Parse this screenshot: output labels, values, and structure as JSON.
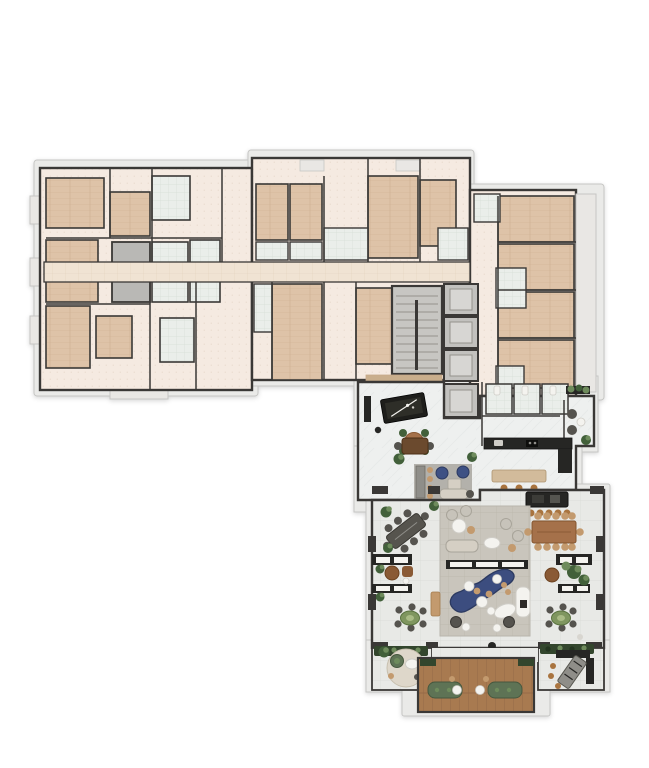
{
  "meta": {
    "label": "residential floor plan with apartment wings, circulation core and amenity pool terrace",
    "page_background": "#ffffff"
  },
  "areas": [
    "west-apartments-wing",
    "north-apartments-wing",
    "east-apartments-wing",
    "central-corridor",
    "stair-core",
    "elevator-bank",
    "games-lounge",
    "pool-table",
    "lounge-seating",
    "restrooms",
    "reading-nook",
    "kitchen",
    "island-counter",
    "outdoor-bar",
    "pool-terrace",
    "plunge-pool",
    "dining-terrace-west",
    "dining-terrace-east",
    "planter-benches",
    "bistro-tables",
    "sun-deck",
    "outdoor-sofas",
    "grill-station",
    "round-lounge-rug",
    "hedges"
  ],
  "palette": {
    "wall": "#3a3836",
    "slab": "#eaeae8",
    "slabStroke": "#c6c6c4",
    "balcony": "#e9e7e4",
    "unitFloor": "#f5eae1",
    "unitDot": "#e3d3c5",
    "woodFloor": "#dec3a8",
    "woodLine": "#c8a98a",
    "tileFloor": "#eaeeea",
    "tileLine": "#d6ded6",
    "corridorFloor": "#f0e3d3",
    "corridorLine": "#e1d1bd",
    "shaft": "#b9b8b5",
    "stairFloor": "#c7c6c2",
    "stairStep": "#94938c",
    "elevator": "#c2c1be",
    "elevatorCab": "#d7d6d3",
    "marble": "#eef0ef",
    "marbleVein": "#dfe3e2",
    "stone": "#e8e9e6",
    "stoneLine": "#d9dad6",
    "paving": "#c9c5bc",
    "pavingLine": "#bab5aa",
    "pool": "#3c4d7f",
    "poolEdge": "#2c3a61",
    "deckWood": "#a87a50",
    "deckLine": "#906644",
    "hedge": "#33462d",
    "hedgeDark": "#243520",
    "plantDark": "#42603a",
    "plantLight": "#6e8b5c",
    "tableWood": "#a5714a",
    "tableWoodDark": "#6b4a2e",
    "tableDark": "#56544e",
    "counterDark": "#262624",
    "counterMid": "#8f8e89",
    "sofaBeige": "#d5cfc4",
    "sofaGreen": "#5e7355",
    "sofaGreenDark": "#46573e",
    "chairBlue": "#3e5184",
    "chairGray": "#c7c3ba",
    "chairGrayStroke": "#a8a49a",
    "chairDark": "#55534e",
    "fixtureWhite": "#f4f3ef",
    "fixtureStroke": "#cfcdc7",
    "tan": "#c39a6e",
    "brownChair": "#8a5a35",
    "stool": "#a9743f",
    "greenTable": "#7f965f",
    "greenTableDark": "#5a7340",
    "rugGray": "#b3b1ab",
    "rugRound": "#ded7ca",
    "benchTan": "#c9ae8c",
    "feltGreen": "#2e2e28",
    "poolTableBlack": "#1e1e1b"
  }
}
